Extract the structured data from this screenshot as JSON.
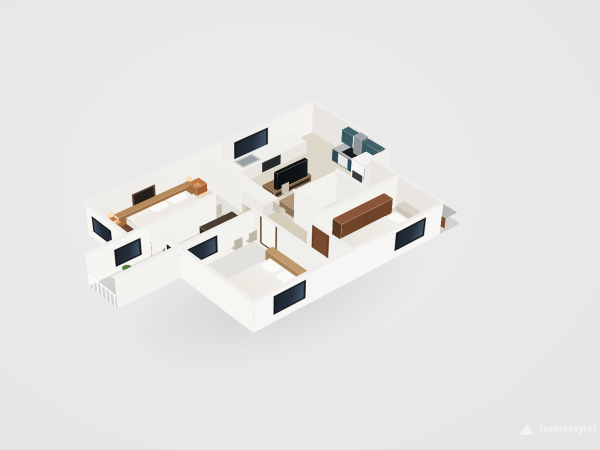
{
  "scene": {
    "type": "isometric-3d-floorplan-render",
    "background_color": "#e9e9e9",
    "view": "isometric bird's-eye, north corner at top"
  },
  "watermark": {
    "logo": "triangle-mountain-logo",
    "text": "homestyler"
  },
  "palette": {
    "background": "#e9e9e9",
    "wall_white": "#f4f2ef",
    "wall_shaded": "#e9e6e2",
    "wall_cap": "#efeeec",
    "floor_main_beige": "#d6ccba",
    "floor_kitchen": "#ddd7c9",
    "floor_bedroom": "#e3e1dd",
    "floor_wood_dark": "#6b4330",
    "floor_balcony_gray": "#cdcfd1",
    "window_glass_navy": "#252f3c",
    "window_frame_dark": "#15181c",
    "window_frame_brown": "#5f4130",
    "cabinet_teal": "#3a5a63",
    "cabinet_navy": "#2e4a57",
    "counter_gray": "#b5b9bb",
    "appliance_black": "#17191c",
    "wood_console": "#7a5c42",
    "wood_table_dark": "#4a3e33",
    "wood_table_light": "#b29476",
    "wardrobe_brown": "#6f4329",
    "door_brown": "#7a4a2e",
    "bed_white": "#f1efea",
    "headboard_wood": "#a87c52",
    "headboard_beige": "#cac3b7",
    "nightstand_orange": "#b4693c",
    "chair_beige": "#cfc9bc",
    "plant_green": "#4e7a3a",
    "lamp_glow": "#ffc178"
  },
  "rooms": [
    {
      "name": "kitchen",
      "items": [
        "navy-window",
        "teal-upper-cabinets",
        "range-hood",
        "black-cooktop",
        "navy-base-cabinets-gray-counter",
        "white-base-cabinets",
        "sink",
        "oven",
        "fridge",
        "white-peninsula-counter"
      ]
    },
    {
      "name": "living-dining",
      "items": [
        "tv",
        "tv-console",
        "dark-dining-table",
        "six-beige-chairs",
        "light-wood-table",
        "beige-chairs",
        "green-plant"
      ]
    },
    {
      "name": "bedroom-1",
      "items": [
        "double-bed-white",
        "wood-headboard-shelf",
        "two-orange-nightstands",
        "two-lit-table-lamps",
        "two-wall-sconces",
        "brown-framed-window",
        "dark-wood-floor-strip"
      ]
    },
    {
      "name": "master-bedroom",
      "items": [
        "double-bed-white",
        "beige-upholstered-headboard",
        "brown-wardrobe",
        "orange-nightstand",
        "lit-table-lamp",
        "dark-framed-windows",
        "brown-door"
      ]
    },
    {
      "name": "bedroom-2",
      "items": [
        "double-bed-white",
        "wood-headboard",
        "orange-stool",
        "lit-sphere-lamp",
        "dark-framed-windows",
        "white-door-brown-frame",
        "dark-wood-floor-strip"
      ]
    },
    {
      "name": "bathroom",
      "items": [
        "white-vanity",
        "toilet"
      ]
    },
    {
      "name": "utility",
      "items": [
        "brown-cabinet-gray-counter",
        "white-appliance"
      ]
    },
    {
      "name": "balcony",
      "items": [
        "white-baluster-railing",
        "two-potted-plants",
        "green-shrubs",
        "gray-floor"
      ]
    },
    {
      "name": "hallway",
      "items": [
        "ceiling-light-glow"
      ]
    }
  ]
}
